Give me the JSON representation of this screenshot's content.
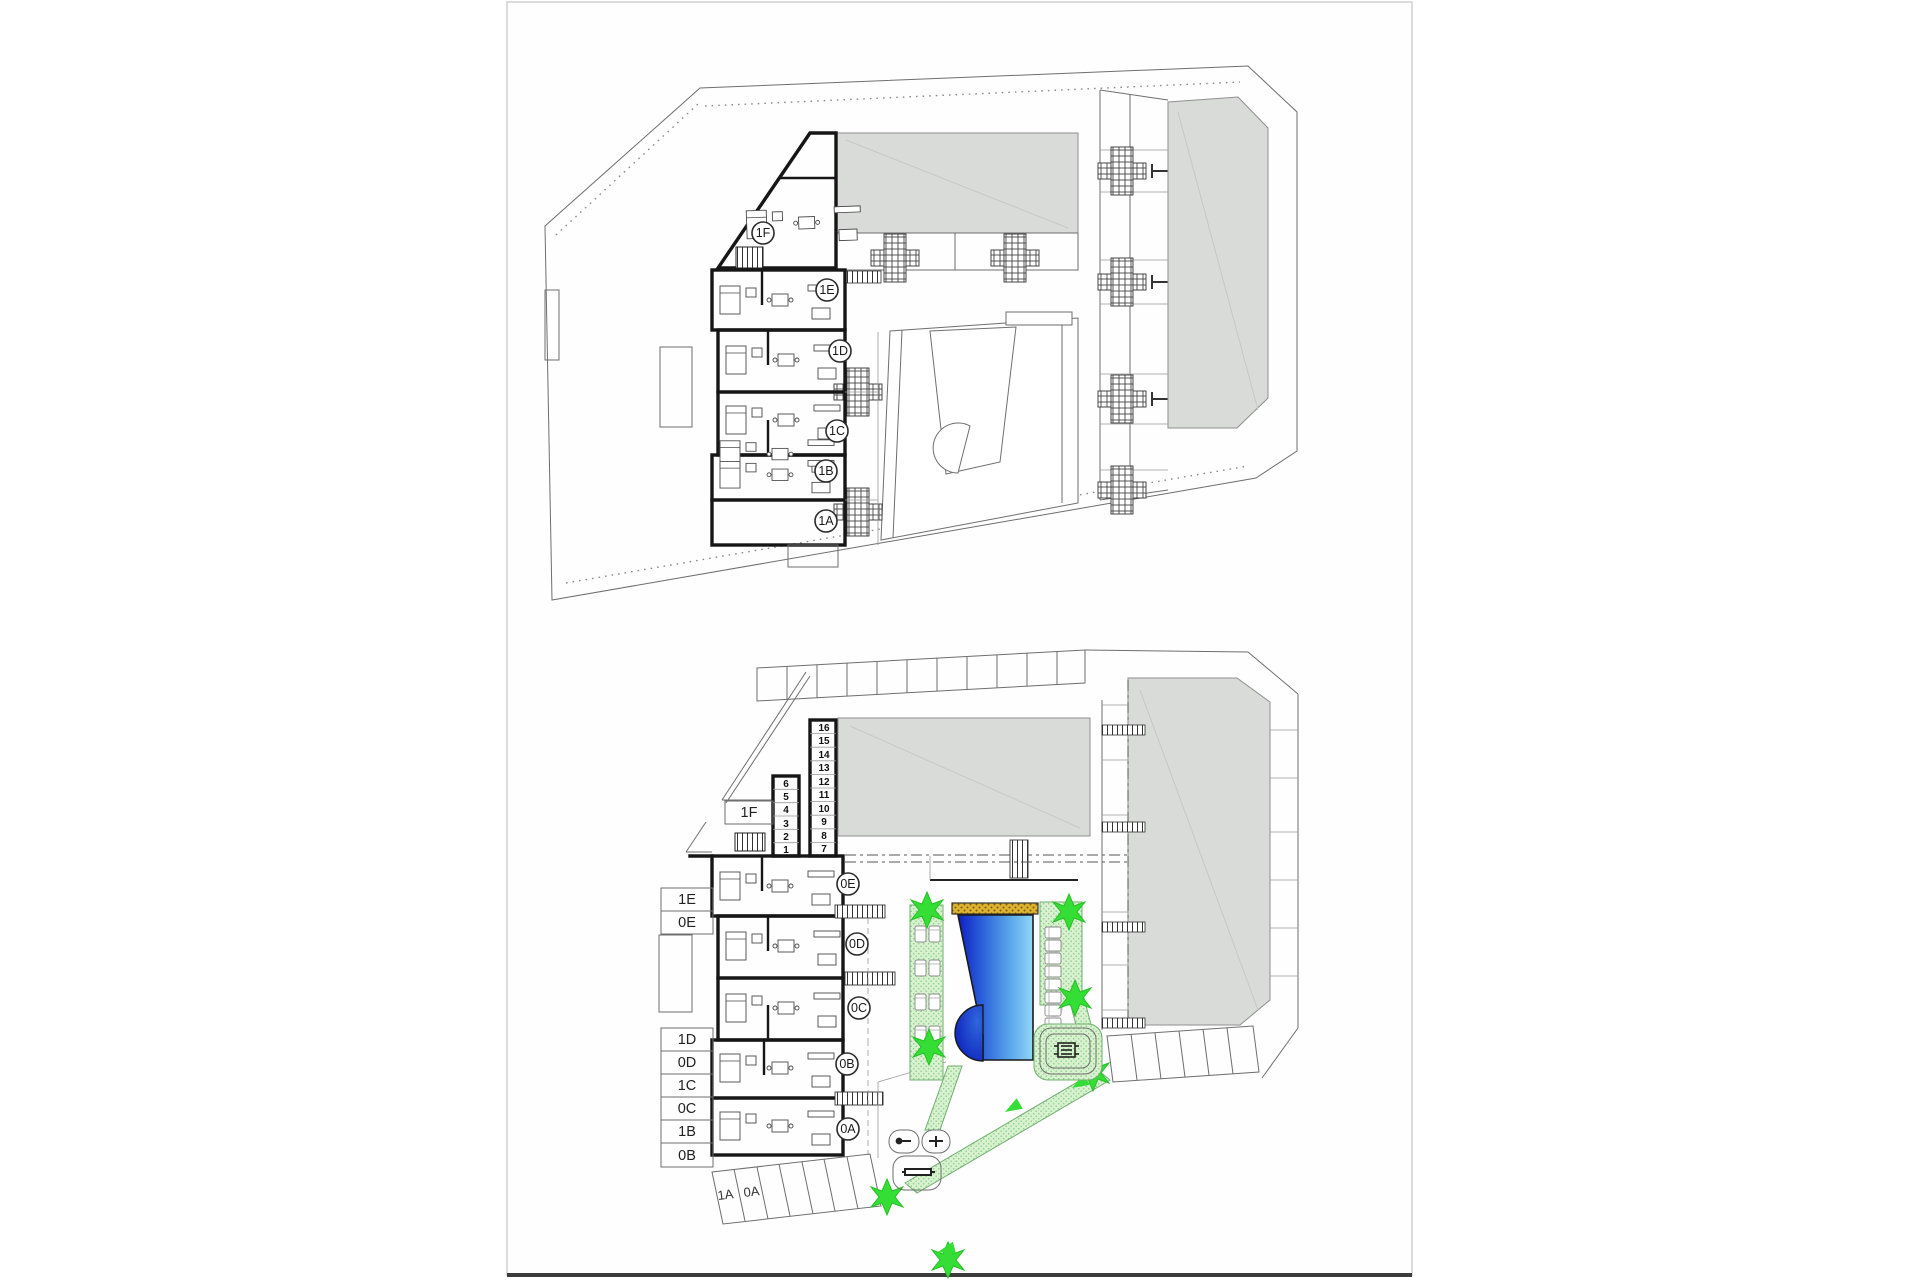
{
  "document": {
    "type": "architectural floor plans",
    "plans": [
      "first-floor-plan",
      "ground-floor-plan"
    ]
  },
  "colors": {
    "wall": "#161616",
    "outline": "#6e6e6e",
    "roof_gray": "#d9dbd9",
    "garden_green": "#d8f2cf",
    "star_green": "#35de35",
    "pool_dark": "#0f1fc4",
    "pool_mid": "#2e66dd",
    "pool_light": "#93d6f6",
    "sand_yellow": "#dfb32f"
  },
  "top_plan": {
    "unit_circles": [
      {
        "label": "1F"
      },
      {
        "label": "1E"
      },
      {
        "label": "1D"
      },
      {
        "label": "1C"
      },
      {
        "label": "1B"
      },
      {
        "label": "1A"
      }
    ]
  },
  "bottom_plan": {
    "unit_circles": [
      {
        "label": "0E"
      },
      {
        "label": "0D"
      },
      {
        "label": "0C"
      },
      {
        "label": "0B"
      },
      {
        "label": "0A"
      }
    ],
    "side_labels": [
      "1E",
      "0E",
      "1D",
      "0D",
      "1C",
      "0C",
      "1B",
      "0B"
    ],
    "storage_box_label": "1F",
    "storage_right": [
      "16",
      "15",
      "14",
      "13",
      "12",
      "11",
      "10",
      "9",
      "8",
      "7"
    ],
    "storage_left": [
      "6",
      "5",
      "4",
      "3",
      "2",
      "1"
    ],
    "parking_labels": [
      "1A",
      "0A"
    ]
  }
}
